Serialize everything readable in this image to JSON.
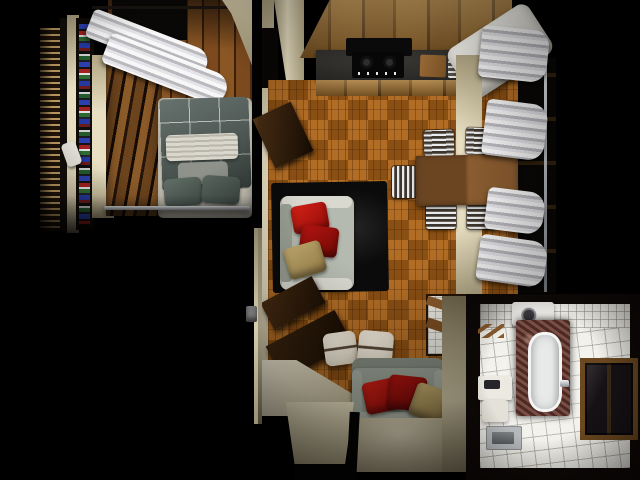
{
  "scene": {
    "description": "Top-down 3D architectural render of a studio apartment at night",
    "view": "top-down",
    "rooms": [
      {
        "name": "bedroom",
        "position": "top-left",
        "furniture": [
          "double-bed-gray-duvet",
          "white-folded-blanket",
          "two-gray-pillows",
          "wood-wardrobe",
          "bookshelf-colorful-books",
          "wood-slat-panel",
          "white-curtains-window",
          "chrome-rail"
        ]
      },
      {
        "name": "kitchen-living-room",
        "position": "center",
        "furniture": [
          "upper-wood-cabinets",
          "dark-countertop",
          "black-cooktop",
          "cutting-board",
          "dish-rack",
          "white-refrigerator",
          "parquet-basketweave-floor",
          "wood-dining-table",
          "five-chrome-slat-chairs",
          "black-shag-rug",
          "gray-sofa-red-tan-cushions",
          "two-white-leather-poufs",
          "gray-loveseat-red-tan-cushions",
          "dark-wood-tv-shelves",
          "white-desk",
          "white-curtains-two-windows",
          "tiled-niche-wood-shelves"
        ]
      },
      {
        "name": "hallway",
        "position": "bottom-center",
        "furniture": [
          "entry-door",
          "light-switch"
        ]
      },
      {
        "name": "bathroom",
        "position": "bottom-right",
        "furniture": [
          "bathtub-marble-surround",
          "washing-machine",
          "pedestal-sink",
          "shower-floor-tray",
          "wood-framed-window",
          "towel-rack",
          "white-tile-floor-walls"
        ]
      }
    ]
  },
  "palette": {
    "bg": "#000000",
    "wall-beige": "#e8dfc2",
    "wall-beige-dark": "#b0a482",
    "floor-parquet": "#a55e17",
    "plank-wood": "#7c4a1e",
    "plank-wood-dark": "#4e2c0f",
    "cabinet-wood": "#8f6228",
    "cabinet-wood-dark": "#6b4418",
    "counter-dark": "#312f2b",
    "curtain-white": "#efefef",
    "curtain-shadow": "#b9b9be",
    "rug-black": "#0b0b0b",
    "sofa-gray": "#b5bab0",
    "sofa-gray-dark": "#9aa295",
    "cushion-red": "#c1170f",
    "cushion-red-dark": "#930d0a",
    "cushion-tan": "#bda462",
    "pouf-cream": "#eae2d2",
    "bed-duvet": "#4e5a55",
    "pillow-gray": "#8e928b",
    "mattress-white": "#d9d4c6",
    "tile-white": "#f1f0ea",
    "marble-brown": "#6a3a30",
    "chrome": "#ccd0d4",
    "table-wood": "#6b4522",
    "table-wood-light": "#8a5c30",
    "books-blue": "#2b3fae",
    "books-red": "#a32020",
    "books-green": "#2e6b33",
    "window-dark": "#0a0806",
    "fridge-white": "#e9e7e1"
  }
}
